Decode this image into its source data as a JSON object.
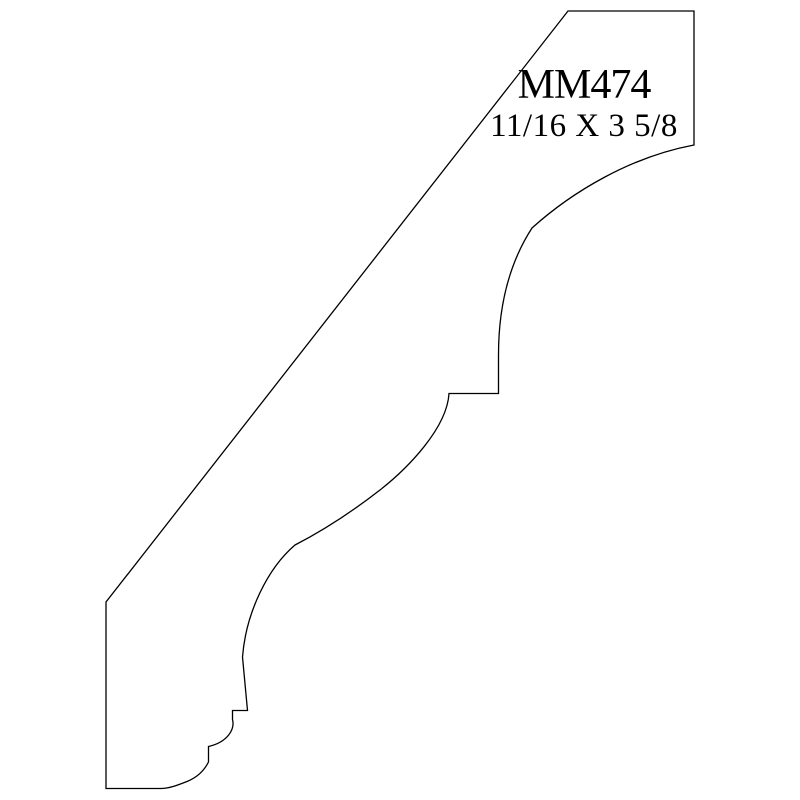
{
  "page": {
    "background": "#ffffff"
  },
  "drawing": {
    "type": "molding-profile-cross-section",
    "profile_code": "MM474",
    "dimensions_label": "11/16 X 3 5/8",
    "line_color": "#000000",
    "outline_path": "M 568,11 L 694,11 L 694,145 C 630,157 572,192 532,228 C 510,262 498.5,305 498.5,355 L 498.5,393.5 L 449,393.5 C 447,428 408,468 380,490 C 362,504 330,527 295,545 C 268,568 246,612 242.5,657 L 247.5,710.5 L 232.5,710.5 L 232.5,719.5 C 235,729 228,742 208.5,746.5 L 208.5,762 C 204,771 197,777.5 187,781.5 C 179,784.5 170,788.5 161,788.5 L 106,788.5 L 106,602 Z"
  }
}
